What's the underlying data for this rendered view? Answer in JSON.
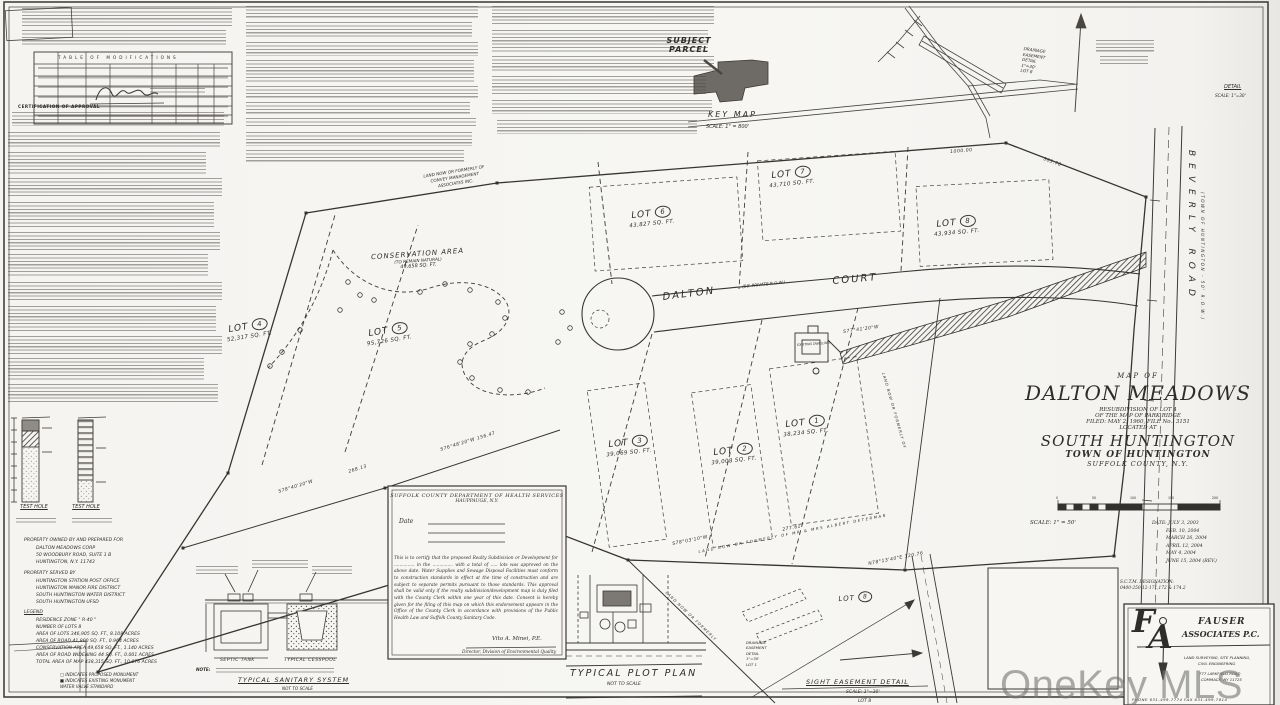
{
  "watermark": {
    "text": "OneKey MLS"
  },
  "sheet": {
    "table_title": "TABLE   OF   MODIFICATIONS",
    "cert_heading": "CERTIFICATION OF APPROVAL"
  },
  "key_map": {
    "title": "KEY MAP",
    "scale": "SCALE: 1\" = 800'",
    "subject1": "SUBJECT",
    "subject2": "PARCEL"
  },
  "top_right_detail": {
    "title": "DETAIL",
    "scale": "SCALE: 1\"=30'"
  },
  "drainage_top": {
    "l1": "DRAINAGE",
    "l2": "EASEMENT",
    "l3": "DETAIL",
    "l4": "1\"=30'",
    "l5": "LOT 8"
  },
  "road": {
    "name1": "DALTON",
    "row": "(50' PRIVATE R.O.W.)",
    "name2": "COURT"
  },
  "beverly": {
    "name": "BEVERLY  ROAD",
    "note": "(TOWN OF HUNTINGTON - 50' R.O.W.)"
  },
  "conservation": {
    "l1": "CONSERVATION AREA",
    "l2": "(TO REMAIN NATURAL)",
    "l3": "49,658 SQ. FT."
  },
  "lots": [
    {
      "word": "LOT",
      "num": "1",
      "area": "38,234 SQ. FT."
    },
    {
      "word": "LOT",
      "num": "2",
      "area": "39,008 SQ. FT."
    },
    {
      "word": "LOT",
      "num": "3",
      "area": "39,069 SQ. FT."
    },
    {
      "word": "LOT",
      "num": "4",
      "area": "52,317 SQ. FT."
    },
    {
      "word": "LOT",
      "num": "5",
      "area": "95,726 SQ. FT."
    },
    {
      "word": "LOT",
      "num": "6",
      "area": "43,827 SQ. FT."
    },
    {
      "word": "LOT",
      "num": "7",
      "area": "43,710 SQ. FT."
    },
    {
      "word": "LOT",
      "num": "8",
      "area": "43,934 SQ. FT."
    }
  ],
  "bearings": {
    "b1": "1000.00",
    "b2": "303.76",
    "b3": "S77°41'20\"W",
    "b4": "S78°03'10\"W",
    "b5": "277.61",
    "b6": "N78°13'40\"E  320.76",
    "b7": "S76°48'20\"W  156.47",
    "b8": "268.13",
    "b9": "S78°40'20\"W"
  },
  "labels": {
    "existing_dwelling": "EXISTING DWELLING",
    "nf_determan": "LAND  NOW  OR  FORMERLY  OF  MR  &  MRS  ALBERT  DETERMAN",
    "nf_top_l1": "LAND NOW OR FORMERLY OF",
    "nf_top_l2": "CONVEY MANAGEMENT",
    "nf_top_l3": "ASSOCIATES INC.",
    "nf_generic": "LAND NOW OR FORMERLY OF",
    "nf_generic2": "LAND NOW OR FORMERLY"
  },
  "health_box": {
    "h1": "SUFFOLK COUNTY DEPARTMENT OF HEALTH SERVICES",
    "h2": "HAUPPAUGE, N.Y.",
    "date_label": "Date",
    "body": "This is to certify that the proposed Realty Subdivision or Development for ............... in the ............... with a total of ..... lots was approved on the above date. Water Supplies and Sewage Disposal Facilities must conform to construction standards in effect at the time of construction and are subject to separate permits pursuant to those standards. This approval shall be valid only if the realty subdivision/development map is duly filed with the County Clerk within one year of this date. Consent is hereby given for the filing of this map on which this endorsement appears in the Office of the County Clerk in accordance with provisions of the Public Health Law and Suffolk County Sanitary Code.",
    "sig": "Vito A. Minei, P.E.",
    "sig_title": "Director, Division of Environmental Quality"
  },
  "sanitary": {
    "septic": "SEPTIC TANK",
    "cesspool": "TYPICAL CESSPOOL",
    "note": "NOTE:",
    "title": "TYPICAL SANITARY SYSTEM",
    "nts": "NOT TO SCALE"
  },
  "plot_plan": {
    "title": "TYPICAL PLOT PLAN",
    "nts": "NOT TO SCALE"
  },
  "sight": {
    "title": "SIGHT EASEMENT DETAIL",
    "scale": "SCALE: 1\"=30'",
    "lot": "LOT 8"
  },
  "drainage_detail": {
    "l1": "DRAINAGE",
    "l2": "EASEMENT",
    "l3": "DETAIL",
    "l4": "1\"=30'",
    "l5": "LOT 1"
  },
  "test_holes": {
    "label1": "TEST HOLE",
    "label2": "TEST HOLE"
  },
  "owner": {
    "l1": "PROPERTY OWNED BY AND PREPARED FOR",
    "l2": "DALTON MEADOWS CORP",
    "l3": "50 WOODBURY ROAD, SUITE 1 B",
    "l4": "HUNTINGTON, N.Y. 11743"
  },
  "served": {
    "l1": "PROPERTY SERVED BY",
    "l2": "HUNTINGTON STATION POST OFFICE",
    "l3": "HUNTINGTON MANOR FIRE DISTRICT",
    "l4": "SOUTH HUNTINGTON WATER DISTRICT",
    "l5": "SOUTH HUNTINGTON UFSD"
  },
  "legend": {
    "title": "LEGEND",
    "l1": "RESIDENCE ZONE \" R-40 \"",
    "l2": "NUMBER OF LOTS 8",
    "l3": "AREA OF LOTS 346,905 SQ. FT., 8.108 ACRES",
    "l4": "AREA OF ROAD 41,800 SQ. FT., 0.964 ACRES",
    "l5": "CONSERVATION AREA 49,658 SQ. FT., 1.140 ACRES",
    "l6": "AREA OF ROAD WIDENING 44 SQ. FT., 0.001 ACRES",
    "l7": "TOTAL AREA OF MAP 438,315 SQ. FT., 10.076 ACRES",
    "s1": "INDICATES PROPOSED MONUMENT",
    "s2": "INDICATES EXISTING MONUMENT",
    "s3": "WATER VALVE STANDARD"
  },
  "title_block": {
    "map_of": "MAP  OF",
    "name": "DALTON  MEADOWS",
    "sub1": "RESUBDIVISION OF LOT 4",
    "sub2": "OF THE MAP OF PARK RIDGE",
    "sub3": "FILED: MAY 2, 1960,  FILE No.: 3151",
    "sub4": "LOCATED AT",
    "place": "SOUTH  HUNTINGTON",
    "town": "TOWN  OF  HUNTINGTON",
    "county": "SUFFOLK  COUNTY,  N.Y.",
    "tick0": "0",
    "tick1": "50",
    "tick2": "100",
    "tick3": "150",
    "tick4": "200",
    "scale": "SCALE: 1\" = 50'",
    "date1": "DATE: JULY 3, 2003",
    "date2": "FEB. 10, 2004",
    "date3": "MARCH 26, 2004",
    "date4": "APRIL 12, 2004",
    "date5": "MAY 4, 2004",
    "date6": "JUNE 15, 2004 (REV.)",
    "sctm1": "S.C.T.M. DESIGNATION:",
    "sctm2": "0400-250-12-171,172 & 174.2"
  },
  "fauser": {
    "f": "F",
    "a": "A",
    "name1": "FAUSER",
    "name2": "ASSOCIATES P.C.",
    "svc1": "LAND SURVEYING, SITE PLANNING,",
    "svc2": "CIVIL ENGINEERING",
    "addr1": "777 LARKFIELD ROAD",
    "addr2": "COMMACK, NY 11725",
    "phone": "PHONE 631-499-7774        FAX 631-499-7814"
  }
}
